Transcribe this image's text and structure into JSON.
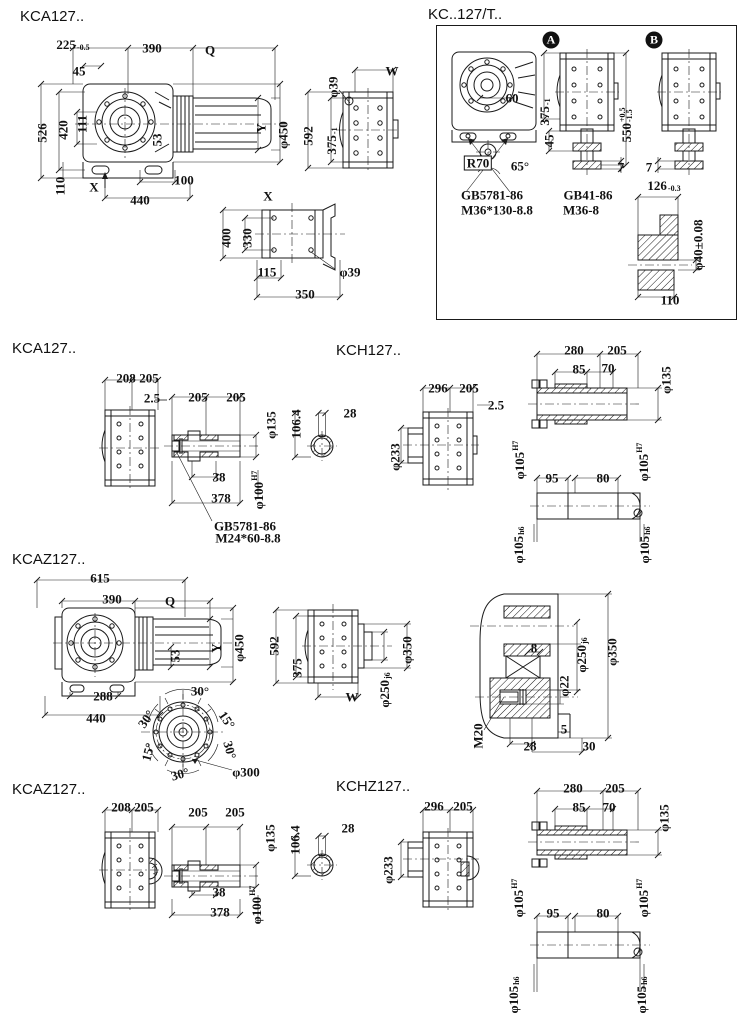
{
  "page": {
    "width": 740,
    "height": 1024,
    "background": "#ffffff",
    "ink": "#1a1a1a"
  },
  "sections": {
    "kca127_overall": {
      "title": "KCA127..",
      "labels": [
        {
          "t": "225",
          "sub": "-0.5",
          "x": 73,
          "y": 44
        },
        {
          "t": "390",
          "x": 152,
          "y": 48
        },
        {
          "t": "Q",
          "x": 210,
          "y": 50
        },
        {
          "t": "45",
          "x": 79,
          "y": 71
        },
        {
          "t": "526",
          "x": 42,
          "y": 133,
          "r": -90
        },
        {
          "t": "420",
          "x": 63,
          "y": 130,
          "r": -90
        },
        {
          "t": "111",
          "x": 82,
          "y": 124,
          "r": -90
        },
        {
          "t": "53",
          "x": 157,
          "y": 140,
          "r": -90
        },
        {
          "t": "Y",
          "x": 261,
          "y": 128,
          "r": -90
        },
        {
          "t": "φ450",
          "x": 283,
          "y": 135,
          "r": -90
        },
        {
          "t": "110",
          "x": 60,
          "y": 186,
          "r": -90
        },
        {
          "t": "X",
          "x": 94,
          "y": 187
        },
        {
          "t": "100",
          "x": 184,
          "y": 180
        },
        {
          "t": "440",
          "x": 140,
          "y": 200
        },
        {
          "t": "φ39",
          "x": 333,
          "y": 87,
          "r": -90
        },
        {
          "t": "W",
          "x": 392,
          "y": 71
        },
        {
          "t": "592",
          "x": 308,
          "y": 136,
          "r": -90
        },
        {
          "t": "375",
          "sub": "-1",
          "x": 331,
          "y": 141,
          "r": -90
        },
        {
          "t": "X",
          "x": 268,
          "y": 196
        },
        {
          "t": "400",
          "x": 226,
          "y": 238,
          "r": -90
        },
        {
          "t": "330",
          "x": 247,
          "y": 238,
          "r": -90
        },
        {
          "t": "115",
          "x": 267,
          "y": 272
        },
        {
          "t": "φ39",
          "x": 350,
          "y": 272
        },
        {
          "t": "350",
          "x": 305,
          "y": 294
        }
      ]
    },
    "kc127t": {
      "title": "KC..127/T..",
      "labels": [
        {
          "t": "A",
          "cls": "circ",
          "x": 551,
          "y": 40
        },
        {
          "t": "B",
          "cls": "circ",
          "x": 654,
          "y": 40
        },
        {
          "t": "60",
          "x": 512,
          "y": 98
        },
        {
          "t": "R70",
          "cls": "boxed",
          "x": 478,
          "y": 163
        },
        {
          "t": "65°",
          "x": 520,
          "y": 166
        },
        {
          "t": "375",
          "sub": "-1",
          "x": 544,
          "y": 112,
          "r": -90
        },
        {
          "t": "45",
          "x": 549,
          "y": 141,
          "r": -90
        },
        {
          "t": "550",
          "sup": "+0.5",
          "sub": "-1.5",
          "x": 626,
          "y": 125,
          "r": -90
        },
        {
          "t": "7",
          "x": 621,
          "y": 167
        },
        {
          "t": "7",
          "x": 649,
          "y": 167
        },
        {
          "t": "GB5781-86",
          "x": 492,
          "y": 195
        },
        {
          "t": "M36*130-8.8",
          "x": 497,
          "y": 210
        },
        {
          "t": "GB41-86",
          "x": 588,
          "y": 195
        },
        {
          "t": "M36-8",
          "x": 581,
          "y": 210
        },
        {
          "t": "126",
          "sub": "-0.3",
          "x": 664,
          "y": 185
        },
        {
          "t": "φ40±0.08",
          "x": 698,
          "y": 245,
          "r": -90
        },
        {
          "t": "110",
          "x": 670,
          "y": 300
        }
      ]
    },
    "kca127_shafts": {
      "title": "KCA127..",
      "labels": [
        {
          "t": "208",
          "x": 126,
          "y": 378
        },
        {
          "t": "205",
          "x": 149,
          "y": 378
        },
        {
          "t": "2.5",
          "x": 152,
          "y": 398
        },
        {
          "t": "205",
          "x": 198,
          "y": 397
        },
        {
          "t": "205",
          "x": 236,
          "y": 397
        },
        {
          "t": "φ135",
          "x": 271,
          "y": 425,
          "r": -90
        },
        {
          "t": "106.4",
          "x": 296,
          "y": 424,
          "r": -90
        },
        {
          "t": "28",
          "x": 350,
          "y": 413
        },
        {
          "t": "38",
          "x": 219,
          "y": 477
        },
        {
          "t": "378",
          "x": 221,
          "y": 498
        },
        {
          "t": "φ100",
          "sup": "H7",
          "x": 258,
          "y": 490,
          "r": -90
        },
        {
          "t": "GB5781-86",
          "x": 245,
          "y": 526
        },
        {
          "t": "M24*60-8.8",
          "x": 248,
          "y": 538
        }
      ]
    },
    "kch127": {
      "title": "KCH127..",
      "labels": [
        {
          "t": "296",
          "x": 438,
          "y": 388
        },
        {
          "t": "205",
          "x": 469,
          "y": 388
        },
        {
          "t": "2.5",
          "x": 496,
          "y": 405
        },
        {
          "t": "φ233",
          "x": 395,
          "y": 457,
          "r": -90
        },
        {
          "t": "280",
          "x": 574,
          "y": 350
        },
        {
          "t": "205",
          "x": 617,
          "y": 350
        },
        {
          "t": "85",
          "x": 579,
          "y": 369
        },
        {
          "t": "70",
          "x": 608,
          "y": 368
        },
        {
          "t": "φ135",
          "x": 666,
          "y": 380,
          "r": -90
        },
        {
          "t": "φ105",
          "sup": "H7",
          "x": 519,
          "y": 460,
          "r": -90
        },
        {
          "t": "φ105",
          "sup": "H7",
          "x": 643,
          "y": 462,
          "r": -90
        },
        {
          "t": "95",
          "x": 552,
          "y": 478
        },
        {
          "t": "80",
          "x": 603,
          "y": 478
        },
        {
          "t": "φ105",
          "sub": "h6",
          "x": 518,
          "y": 545,
          "r": -90
        },
        {
          "t": "φ105",
          "sub": "h6",
          "x": 644,
          "y": 545,
          "r": -90
        }
      ]
    },
    "kcaz127_overall": {
      "title": "KCAZ127..",
      "labels": [
        {
          "t": "615",
          "x": 100,
          "y": 578
        },
        {
          "t": "390",
          "x": 112,
          "y": 599
        },
        {
          "t": "Q",
          "x": 170,
          "y": 601
        },
        {
          "t": "Y",
          "x": 216,
          "y": 648,
          "r": -90
        },
        {
          "t": "φ450",
          "x": 239,
          "y": 648,
          "r": -90
        },
        {
          "t": "592",
          "x": 274,
          "y": 646,
          "r": -90
        },
        {
          "t": "53",
          "x": 175,
          "y": 656,
          "r": -90
        },
        {
          "t": "288",
          "x": 103,
          "y": 696
        },
        {
          "t": "440",
          "x": 96,
          "y": 718
        },
        {
          "t": "30°",
          "x": 200,
          "y": 691
        },
        {
          "t": "30°",
          "x": 146,
          "y": 719,
          "r": -55
        },
        {
          "t": "15°",
          "x": 148,
          "y": 752,
          "r": -75
        },
        {
          "t": "30°",
          "x": 180,
          "y": 774,
          "r": -15
        },
        {
          "t": "15°",
          "x": 227,
          "y": 720,
          "r": 55
        },
        {
          "t": "30°",
          "x": 230,
          "y": 750,
          "r": 75
        },
        {
          "t": "φ300",
          "x": 246,
          "y": 772
        },
        {
          "t": "375",
          "x": 297,
          "y": 668,
          "r": -90
        },
        {
          "t": "W",
          "x": 352,
          "y": 697
        },
        {
          "t": "φ250",
          "sub": "j6",
          "x": 384,
          "y": 690,
          "r": -90
        },
        {
          "t": "φ350",
          "x": 407,
          "y": 650,
          "r": -90
        },
        {
          "t": "8",
          "x": 534,
          "y": 648
        },
        {
          "t": "φ250",
          "sub": "j6",
          "x": 581,
          "y": 655,
          "r": -90
        },
        {
          "t": "φ350",
          "x": 612,
          "y": 652,
          "r": -90
        },
        {
          "t": "φ22",
          "x": 564,
          "y": 686,
          "r": -90
        },
        {
          "t": "M20",
          "x": 478,
          "y": 736,
          "r": -90
        },
        {
          "t": "5",
          "x": 564,
          "y": 729
        },
        {
          "t": "28",
          "x": 530,
          "y": 746
        },
        {
          "t": "30",
          "x": 589,
          "y": 746
        }
      ]
    },
    "kcaz127_shafts": {
      "title": "KCAZ127..",
      "labels": [
        {
          "t": "208",
          "x": 121,
          "y": 807
        },
        {
          "t": "205",
          "x": 144,
          "y": 807
        },
        {
          "t": "205",
          "x": 198,
          "y": 812
        },
        {
          "t": "205",
          "x": 235,
          "y": 812
        },
        {
          "t": "φ135",
          "x": 270,
          "y": 838,
          "r": -90
        },
        {
          "t": "106.4",
          "x": 295,
          "y": 840,
          "r": -90
        },
        {
          "t": "28",
          "x": 348,
          "y": 828
        },
        {
          "t": "38",
          "x": 219,
          "y": 892
        },
        {
          "t": "378",
          "x": 220,
          "y": 912
        },
        {
          "t": "φ100",
          "sup": "H7",
          "x": 256,
          "y": 905,
          "r": -90
        }
      ]
    },
    "kchz127": {
      "title": "KCHZ127..",
      "labels": [
        {
          "t": "296",
          "x": 434,
          "y": 806
        },
        {
          "t": "205",
          "x": 463,
          "y": 806
        },
        {
          "t": "φ233",
          "x": 388,
          "y": 870,
          "r": -90
        },
        {
          "t": "280",
          "x": 573,
          "y": 788
        },
        {
          "t": "205",
          "x": 615,
          "y": 788
        },
        {
          "t": "85",
          "x": 579,
          "y": 807
        },
        {
          "t": "70",
          "x": 609,
          "y": 807
        },
        {
          "t": "φ135",
          "x": 664,
          "y": 818,
          "r": -90
        },
        {
          "t": "φ105",
          "sup": "H7",
          "x": 518,
          "y": 898,
          "r": -90
        },
        {
          "t": "φ105",
          "sup": "H7",
          "x": 643,
          "y": 898,
          "r": -90
        },
        {
          "t": "95",
          "x": 553,
          "y": 913
        },
        {
          "t": "80",
          "x": 603,
          "y": 913
        },
        {
          "t": "φ105",
          "sub": "h6",
          "x": 513,
          "y": 995,
          "r": -90
        },
        {
          "t": "φ105",
          "sub": "h6",
          "x": 641,
          "y": 995,
          "r": -90
        }
      ]
    }
  }
}
